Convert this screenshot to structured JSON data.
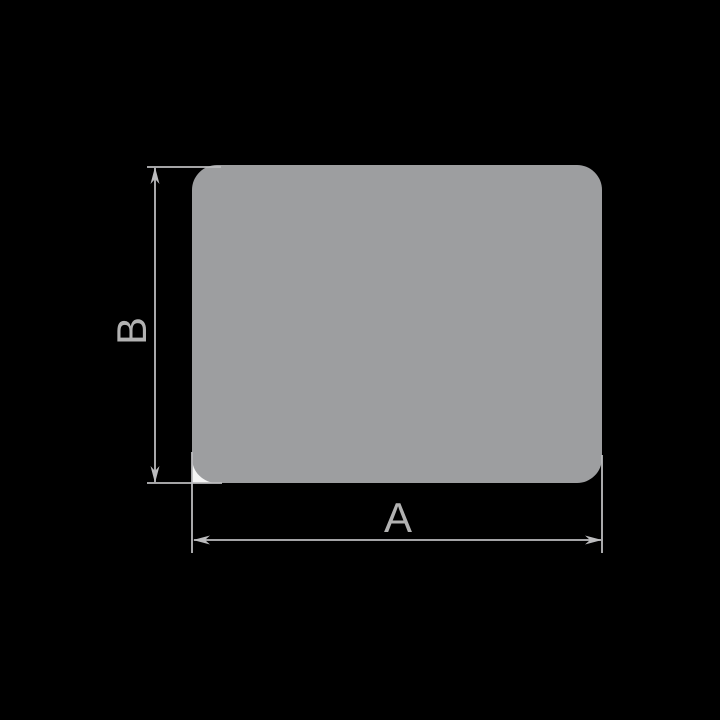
{
  "diagram": {
    "kind": "rounded-rectangle-profile-with-dimensions",
    "labels": {
      "width": "A",
      "height": "B"
    },
    "colors": {
      "background": "#000000",
      "shape_fill": "#9d9ea0",
      "dimension_lines": "#bcbcbe",
      "label_text": "#b2b2b2",
      "corner_notch": "#f5f5f5"
    }
  }
}
